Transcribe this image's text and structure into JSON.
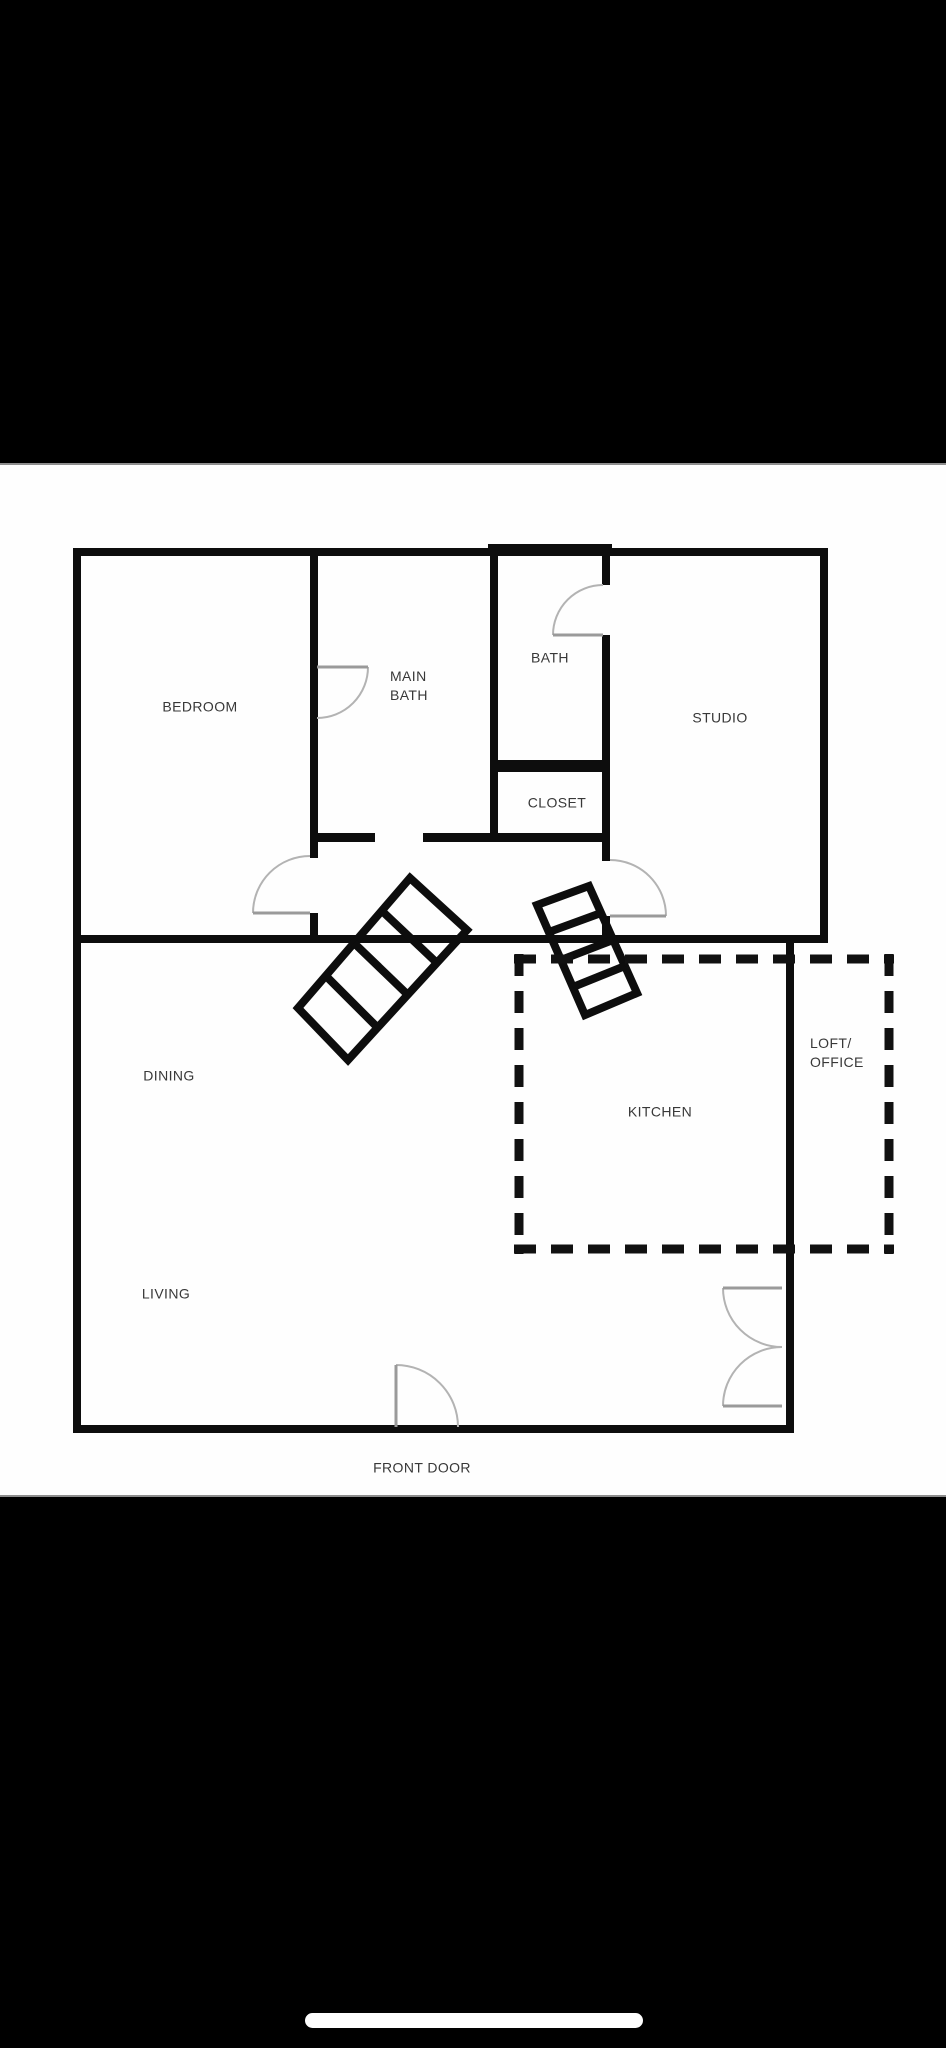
{
  "floor_plan": {
    "rooms": {
      "bedroom": "BEDROOM",
      "main_bath": "MAIN\nBATH",
      "bath": "BATH",
      "studio": "STUDIO",
      "closet": "CLOSET",
      "dining": "DINING",
      "kitchen": "KITCHEN",
      "loft_office": "LOFT/\nOFFICE",
      "living": "LIVING",
      "front_door": "FRONT DOOR"
    },
    "colors": {
      "wall": "#0d0d0d",
      "dashed_outline": "#111111",
      "door_arc": "#b3b3b3",
      "door_leaf": "#9a9a9a",
      "label_text": "#383838",
      "paper": "#fefefe",
      "device_bars": "#000000"
    }
  }
}
